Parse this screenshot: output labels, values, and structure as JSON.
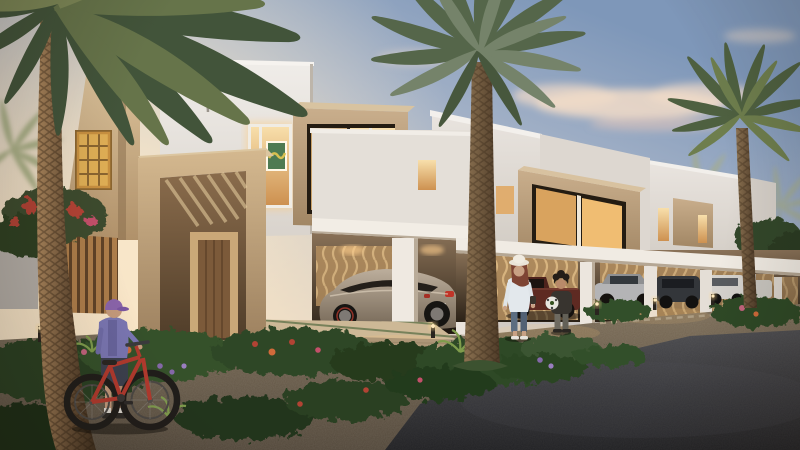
{
  "image": {
    "kind": "3d-architectural-rendering",
    "subject": "Row of modern flat-roofed townhouses at dusk with lit box windows, carports with parked cars, date palms, flowering garden beds, a gravel walkway and an asphalt street",
    "time_of_day": "dusk"
  },
  "palette": {
    "sky_top_right": "#7e97b9",
    "sky_mid": "#c9c6c4",
    "sky_warm_left": "#f8e8cd",
    "cloud": "#f2dcc8",
    "wall_white": "#e9e5e0",
    "wall_white_shade": "#d8d2cb",
    "wall_beige": "#cfb48c",
    "frame_taupe": "#bba084",
    "window_warm": "#f0bd72",
    "lattice_amber": "#dfae55",
    "palm_green_dark": "#46583a",
    "palm_green_lit": "#6d7d4e",
    "palm_green_pale": "#a3ac94",
    "trunk_brown": "#7c5f43",
    "foliage_dark": "#2e4226",
    "flower_red": "#b24334",
    "flower_pink": "#c4647e",
    "flower_purple": "#8468a8",
    "gravel": "#6a5c4b",
    "asphalt": "#2d2d2f",
    "paver": "#c9b494",
    "timber": "#b08048",
    "car_bronze": "#968572",
    "car_silver": "#b4b4b6",
    "car_white": "#d5d2cd",
    "car_dark": "#33363a",
    "car_maroon": "#5e2a22",
    "bike_red": "#b23a2e",
    "cap_purple": "#8a64aa",
    "bollard_glow": "#ffd98e"
  },
  "scene_elements": {
    "buildings": [
      "white flat-roof townhouse volumes receding to the right",
      "beige tower with amber lattice (mashrabiya) window",
      "taupe projecting box windows with warm lit interiors and artwork",
      "recessed entrance portal with pergola slats and timber door",
      "carport canopies with white columns and gold patterned screen walls"
    ],
    "vehicles": [
      "bronze coupe under first carport",
      "maroon pickup",
      "silver sedan",
      "dark suv",
      "white van"
    ],
    "figures": [
      "woman in sun hat walking",
      "boy holding a football",
      "child in purple cap pushing a red bicycle"
    ],
    "vegetation": [
      "large foreground date palms",
      "hazy distant palms",
      "bougainvillea and flowering shrubs",
      "garden hedges along the street"
    ],
    "ground": [
      "stone paver walkway",
      "gravel path",
      "asphalt street",
      "bollard path lights"
    ]
  }
}
